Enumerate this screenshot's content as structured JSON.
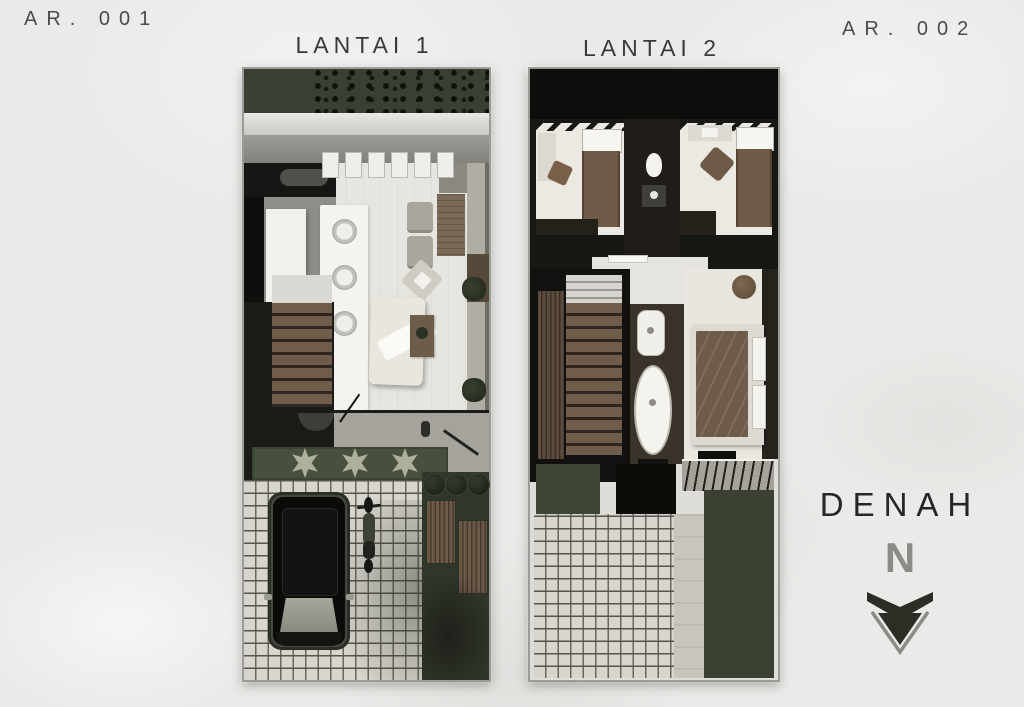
{
  "labels": {
    "sheet_left": "AR. 001",
    "sheet_right": "AR. 002",
    "plan1_title": "LANTAI 1",
    "plan2_title": "LANTAI 2",
    "legend_title": "DENAH",
    "north": "N"
  },
  "plans": [
    {
      "id": "lantai-1",
      "title": "LANTAI 1",
      "sheet_code": "AR. 001"
    },
    {
      "id": "lantai-2",
      "title": "LANTAI 2",
      "sheet_code": "AR. 002"
    }
  ],
  "icons": {
    "north_arrow": "north-arrow-icon"
  },
  "palette": {
    "paper": "#ebeae8",
    "ink": "#3a3a38",
    "muted_ink": "#4b4b49",
    "north_grey": "#8b8b87",
    "roof_green": "#3a3f33",
    "planter_green": "#47503c",
    "wood_brown": "#6f5c4a",
    "blanket_brown": "#6e5a47",
    "wall_black": "#141412",
    "floor_white": "#e9e6e0",
    "paving_grey": "#d7d5ce"
  }
}
